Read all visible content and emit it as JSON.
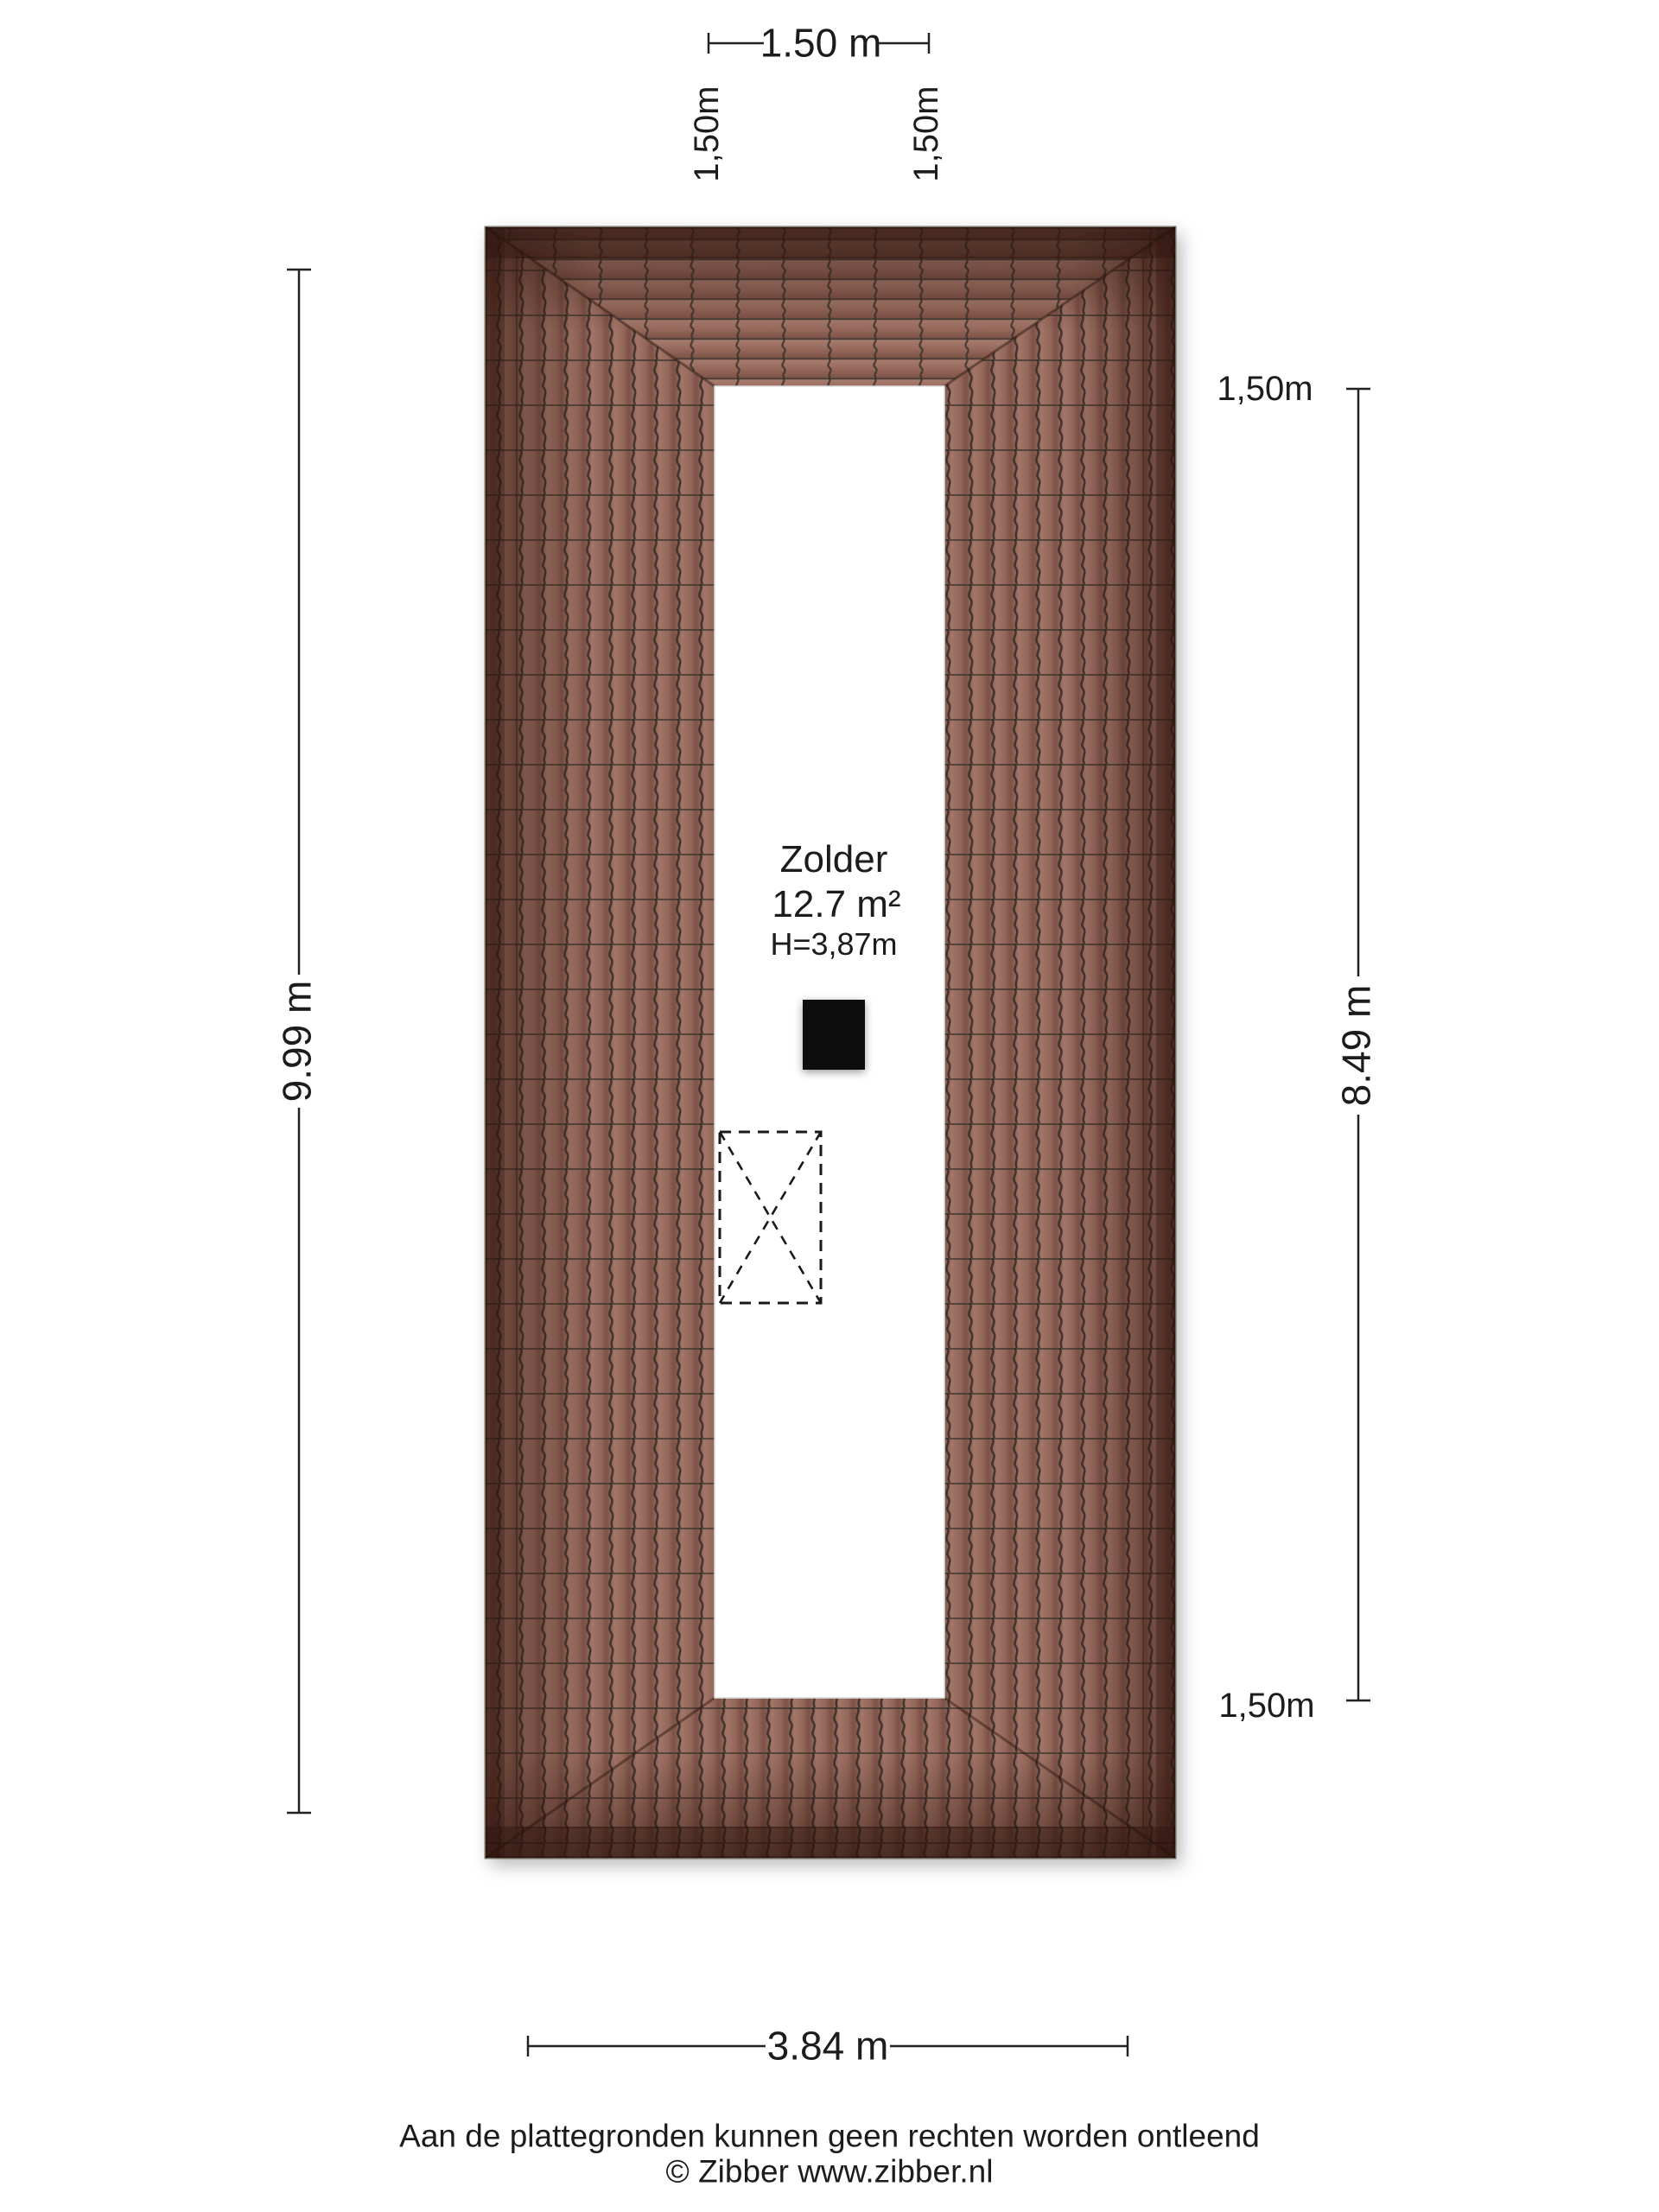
{
  "room": {
    "name": "Zolder",
    "area": "12.7 m²",
    "ceiling_height": "H=3,87m"
  },
  "dimensions": {
    "top_width": "1.50 m",
    "top_left_height_line": "1,50m",
    "top_right_height_line": "1,50m",
    "left_depth": "9.99 m",
    "right_depth": "8.49 m",
    "right_top_height_line": "1,50m",
    "right_bottom_height_line": "1,50m",
    "bottom_width": "3.84 m"
  },
  "footer": {
    "disclaimer": "Aan de plattegronden kunnen geen rechten worden ontleend",
    "copyright": "© Zibber www.zibber.nl"
  },
  "colors": {
    "roof_tile_light": "#aa8172",
    "roof_tile_mid": "#97695c",
    "roof_tile_dark": "#7e5348",
    "roof_edge_dark": "#2e140c",
    "tile_joint": "#3a312c",
    "floor": "#ffffff",
    "chimney": "#0a0a0a",
    "text": "#1c1c1c"
  }
}
